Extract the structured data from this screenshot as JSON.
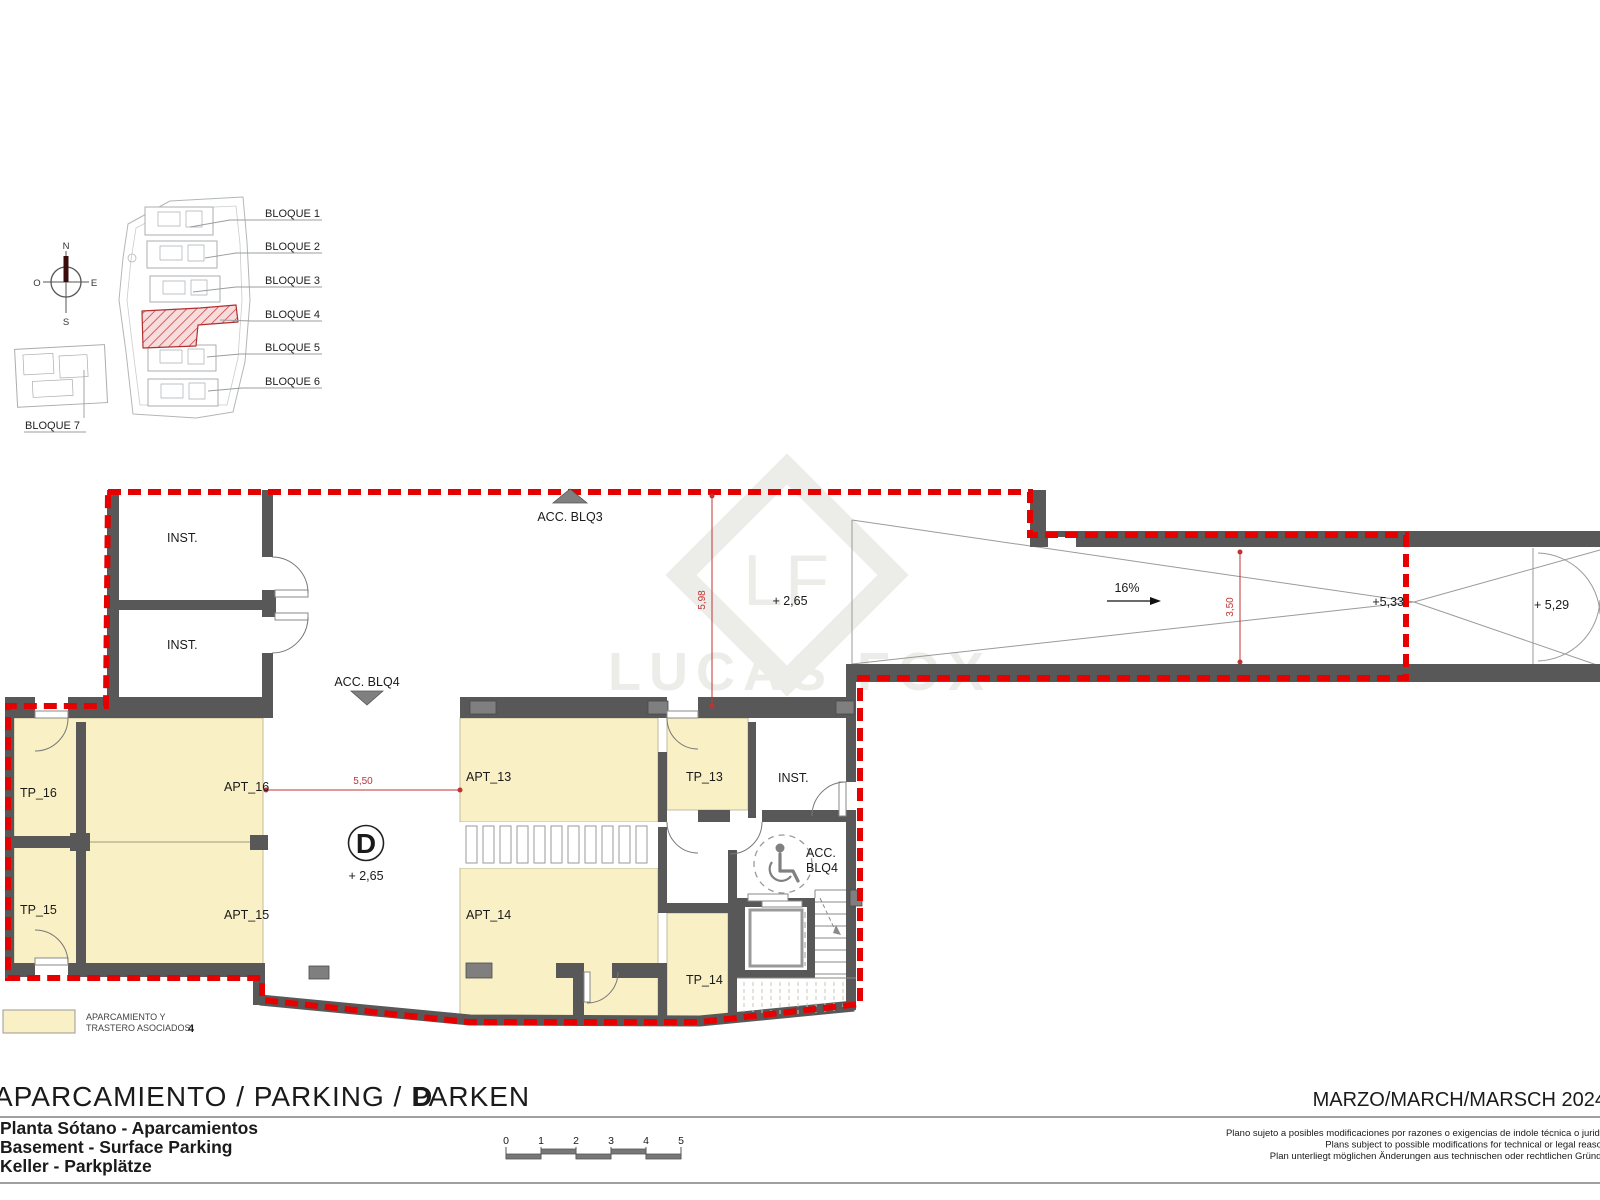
{
  "site_key": {
    "blocks": [
      "BLOQUE 1",
      "BLOQUE 2",
      "BLOQUE 3",
      "BLOQUE 4",
      "BLOQUE 5",
      "BLOQUE 6",
      "BLOQUE 7"
    ],
    "compass": {
      "n": "N",
      "s": "S",
      "e": "E",
      "o": "O"
    }
  },
  "plan": {
    "rooms": {
      "inst_a": "INST.",
      "inst_b": "INST.",
      "inst_c": "INST.",
      "tp16": "TP_16",
      "tp15": "TP_15",
      "tp13": "TP_13",
      "tp14": "TP_14",
      "apt16": "APT_16",
      "apt15": "APT_15",
      "apt13": "APT_13",
      "apt14": "APT_14"
    },
    "access": {
      "blq3": "ACC. BLQ3",
      "blq4": "ACC. BLQ4",
      "acc_line1": "ACC.",
      "acc_line2": "BLQ4"
    },
    "levels": {
      "hall": "+ 2,65",
      "aisle": "+ 2,65",
      "ramp_mid": "+5,33",
      "ramp_end": "+ 5,29"
    },
    "dims": {
      "v598": "5,98",
      "h550": "5,50",
      "v350": "3,50"
    },
    "slope": "16%",
    "sector": "D"
  },
  "legend": {
    "line1": "APARCAMIENTO Y",
    "line2": "TRASTERO ASOCIADOS",
    "num": "4"
  },
  "titleblock": {
    "title": "APARCAMIENTO / PARKING / PARKEN",
    "title_letter": "D",
    "date": "MARZO/MARCH/MARSCH 2024",
    "subtitle_es": "Planta Sótano - Aparcamientos",
    "subtitle_en": "Basement - Surface Parking",
    "subtitle_de": "Keller - Parkplätze",
    "ticks": [
      "0",
      "1",
      "2",
      "3",
      "4",
      "5"
    ],
    "disclaimer_es": "Plano sujeto a posibles modificaciones por razones o exigencias de indole técnica o juridica",
    "disclaimer_en": "Plans subject to possible modifications for technical or legal reasons",
    "disclaimer_de": "Plan unterliegt möglichen Änderungen aus technischen oder rechtlichen Gründen"
  },
  "watermark": {
    "initials": "LF",
    "name": "LUCAS FOX"
  },
  "colors": {
    "boundary": "#e60000",
    "wall": "#585858",
    "parking_fill": "#faf0c5",
    "dim": "#c03333"
  }
}
